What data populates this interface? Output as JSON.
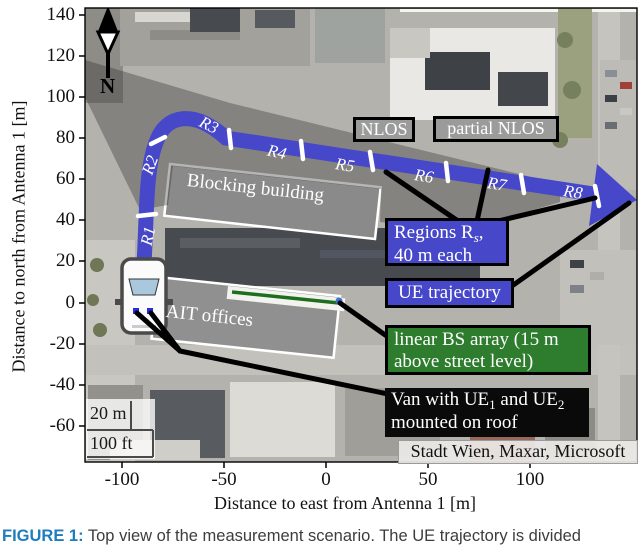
{
  "figure": {
    "tag": "FIGURE 1:",
    "caption": " Top view of the measurement scenario. The UE trajectory is divided"
  },
  "axes": {
    "x_label": "Distance to east from Antenna 1 [m]",
    "y_label": "Distance to north from Antenna 1 [m]",
    "x_ticks": [
      "-100",
      "-50",
      "0",
      "50",
      "100"
    ],
    "y_ticks": [
      "140",
      "120",
      "100",
      "80",
      "60",
      "40",
      "20",
      "0",
      "-20",
      "-40",
      "-60"
    ]
  },
  "compass": {
    "label": "N"
  },
  "scalebar": {
    "metric": "20 m",
    "imperial": "100 ft"
  },
  "map": {
    "blocking_building": "Blocking building",
    "ait_offices": "AIT offices",
    "nlos": "NLOS",
    "partial_nlos": "partial NLOS",
    "attribution": "Stadt Wien, Maxar, Microsoft"
  },
  "trajectory": {
    "regions": [
      "R1",
      "R2",
      "R3",
      "R4",
      "R5",
      "R6",
      "R7",
      "R8"
    ]
  },
  "legend": {
    "regions_prefix": "Regions R",
    "regions_sub": "s",
    "regions_suffix": ",",
    "regions_line2": "40 m each",
    "ue_trajectory": "UE trajectory",
    "bs_line1": "linear BS array (15 m",
    "bs_line2": "above street level)",
    "van_prefix": "Van with UE",
    "van_sub1": "1",
    "van_mid": " and UE",
    "van_sub2": "2",
    "van_line2": "mounted on roof"
  },
  "colors": {
    "trajectory_blue": "#4747c9",
    "legend_green": "#2e7d2e",
    "bs_array_green": "#1e6e1e",
    "building_gray": "#8f8f8f",
    "nlos_box_gray": "#9b9b9b",
    "shadow_overlay": "rgba(42,42,42,0.35)",
    "caption_blue": "#1d7dbd"
  }
}
